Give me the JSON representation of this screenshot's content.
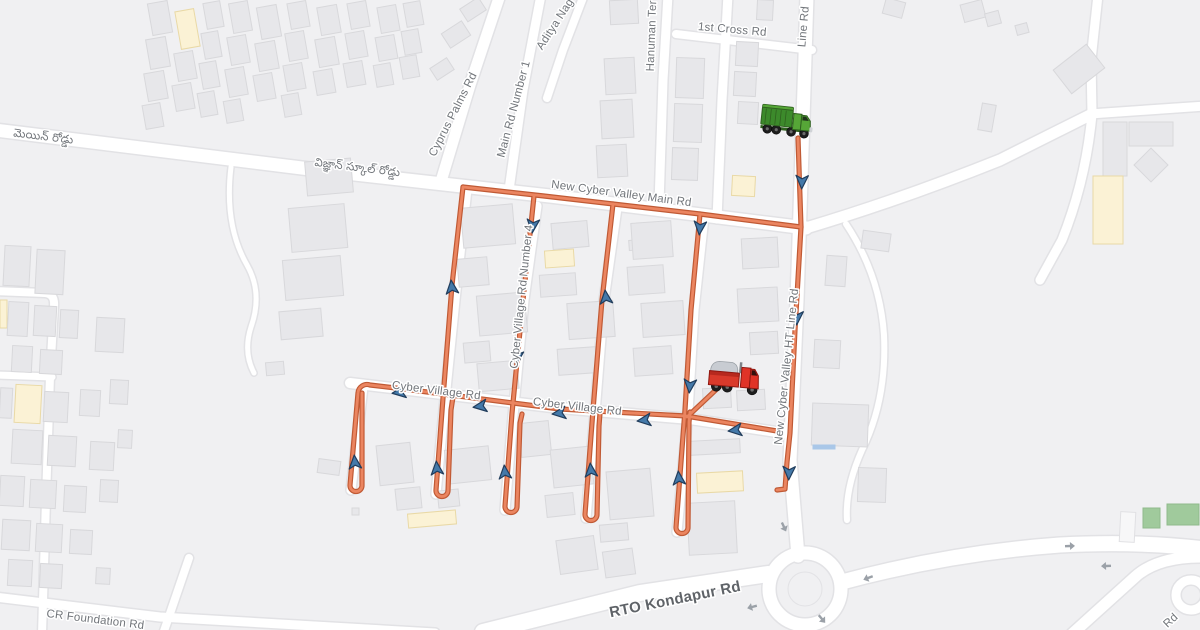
{
  "map": {
    "width": 1200,
    "height": 630,
    "colors": {
      "bg": "#f0f0f2",
      "road_fill": "#ffffff",
      "road_casing": "#e2e2e5",
      "building": "#e7e7ea",
      "building_stroke": "#d8d8db",
      "building_yellow": "#fbf2d5",
      "building_yellow_stroke": "#e9d9a6",
      "building_green": "#a0ca9c",
      "building_green_stroke": "#8fba8c",
      "building_white": "#f7f7f8",
      "building_white_stroke": "#e0e0e3",
      "building_blue": "#a9c7e8",
      "route_casing": "#c05a35",
      "route": "#eb8560",
      "route_arrow_fill": "#4479a9",
      "route_arrow_stroke": "#213d5c",
      "traffic_arrow": "#9ba1a8",
      "label": "#71757a",
      "label_major": "#5f6368"
    },
    "road_labels": [
      {
        "t": "1st Cross Rd",
        "x": 732,
        "y": 33,
        "r": 5,
        "s": 11.5
      },
      {
        "t": "Line Rd",
        "x": 807,
        "y": 27,
        "r": -85,
        "s": 11.5
      },
      {
        "t": "Hanuman Ter",
        "x": 655,
        "y": 36,
        "r": -88,
        "s": 11.5
      },
      {
        "t": "Aditya Nag",
        "x": 558,
        "y": 26,
        "r": -57,
        "s": 11.5
      },
      {
        "t": "Main Rd Number 1",
        "x": 517,
        "y": 110,
        "r": -75,
        "s": 11.5
      },
      {
        "t": "Cyprus Palms Rd",
        "x": 456,
        "y": 116,
        "r": -63,
        "s": 11.5
      },
      {
        "t": "మెయిన్ రోడ్డు",
        "x": 43,
        "y": 140,
        "r": 7,
        "s": 11.5
      },
      {
        "t": "విజ్ఞాన్ స్కూల్ రోడ్డు",
        "x": 357,
        "y": 171,
        "r": 7,
        "s": 11.5
      },
      {
        "t": "New Cyber Valley Main Rd",
        "x": 621,
        "y": 197,
        "r": 7.5,
        "s": 11.5
      },
      {
        "t": "Cyber Village Rd Number 4",
        "x": 525,
        "y": 297,
        "r": -84,
        "s": 11.5
      },
      {
        "t": "New Cyber Valley HT Line Rd",
        "x": 790,
        "y": 367,
        "r": -84,
        "s": 11.5
      },
      {
        "t": "Cyber Village Rd",
        "x": 436,
        "y": 394,
        "r": 7,
        "s": 11.5
      },
      {
        "t": "Cyber Village Rd",
        "x": 577,
        "y": 410,
        "r": 6.5,
        "s": 11.5
      },
      {
        "t": "RTO Kondapur Rd",
        "x": 676,
        "y": 604,
        "r": -11.5,
        "s": 15,
        "w": 600,
        "c": "#5f6368"
      },
      {
        "t": "CR Foundation Rd",
        "x": 95,
        "y": 623,
        "r": 7,
        "s": 11.5
      },
      {
        "t": "Rd",
        "x": 1173,
        "y": 623,
        "r": -43,
        "s": 11.5
      }
    ],
    "roads": [
      {
        "d": "M-5,130 L310,169 L550,196 L806,228",
        "w": 13
      },
      {
        "d": "M806,228 Q900,200 1000,160 L1092,114",
        "w": 11
      },
      {
        "d": "M1090,114 L1205,106",
        "w": 9
      },
      {
        "d": "M1098,-5 L1091,60 L1092,114 Q1086,180 1062,240 L1040,280",
        "w": 9
      },
      {
        "d": "M500,-5 L470,85 L442,178",
        "w": 11
      },
      {
        "d": "M541,-5 L523,90 L509,190",
        "w": 9
      },
      {
        "d": "M584,-5 L563,50 L547,98",
        "w": 8
      },
      {
        "d": "M668,-5 L663,80 L659,205",
        "w": 9
      },
      {
        "d": "M728,-5 L722,100 L717,219",
        "w": 9
      },
      {
        "d": "M676,34 L812,50",
        "w": 8
      },
      {
        "d": "M807,-5 L802,150 L797,300 L790,460 L798,556",
        "w": 13
      },
      {
        "d": "M350,383 L560,408 L690,419 L790,434",
        "w": 10
      },
      {
        "d": "M467,189 L455,300 L445,399 L436,494",
        "w": 9
      },
      {
        "d": "M537,206 L524,300 L513,416 L505,510",
        "w": 9
      },
      {
        "d": "M617,208 L604,300 L595,413 L586,518",
        "w": 9
      },
      {
        "d": "M704,217 L694,310 L688,412 L677,532",
        "w": 9
      },
      {
        "d": "M363,387 L351,490",
        "w": 9
      },
      {
        "d": "M483,632 L640,593 L768,574",
        "w": 16
      },
      {
        "d": "M842,582 Q950,553 1060,545 Q1140,541 1205,549",
        "w": 15
      },
      {
        "d": "M806,625 L808,634",
        "w": 11
      },
      {
        "d": "M1072,634 L1135,577 Q1158,556 1205,557",
        "w": 11
      },
      {
        "circle": [
          1191,
          595,
          15
        ],
        "w": 9
      },
      {
        "circle": [
          805,
          589,
          36
        ],
        "w": 13
      },
      {
        "d": "M-5,291 L45,293 Q55,294 54,306 L50,376 L46,500 L42,634",
        "w": 8
      },
      {
        "d": "M-5,375 L52,377",
        "w": 7
      },
      {
        "d": "M231,167 Q224,225 247,265 Q263,293 251,327 Q243,352 254,373",
        "w": 5
      },
      {
        "d": "M846,224 Q880,275 884,335 Q887,400 862,450 Q845,488 847,520",
        "w": 6
      },
      {
        "d": "M-5,597 L160,617 L435,633",
        "w": 9
      },
      {
        "d": "M189,558 L163,634",
        "w": 8
      }
    ],
    "roundabout_island": [
      805,
      589,
      17
    ],
    "buildings": [
      [
        150,
        2,
        20,
        32,
        -10
      ],
      [
        148,
        38,
        20,
        30,
        -10
      ],
      [
        146,
        72,
        20,
        28,
        -10
      ],
      [
        144,
        104,
        18,
        24,
        -10
      ],
      [
        178,
        10,
        19,
        38,
        -10,
        "y"
      ],
      [
        176,
        52,
        19,
        28,
        -10
      ],
      [
        174,
        84,
        19,
        26,
        -10
      ],
      [
        205,
        2,
        17,
        26,
        -10
      ],
      [
        203,
        32,
        17,
        26,
        -10
      ],
      [
        201,
        62,
        17,
        26,
        -10
      ],
      [
        199,
        92,
        17,
        24,
        -10
      ],
      [
        231,
        2,
        19,
        30,
        -10
      ],
      [
        229,
        36,
        19,
        28,
        -10
      ],
      [
        227,
        68,
        19,
        28,
        -10
      ],
      [
        225,
        100,
        17,
        22,
        -10
      ],
      [
        259,
        6,
        20,
        32,
        -10
      ],
      [
        257,
        42,
        20,
        28,
        -10
      ],
      [
        255,
        74,
        19,
        26,
        -10
      ],
      [
        289,
        2,
        19,
        26,
        -10
      ],
      [
        287,
        32,
        19,
        28,
        -10
      ],
      [
        285,
        64,
        19,
        26,
        -10
      ],
      [
        283,
        94,
        17,
        22,
        -10
      ],
      [
        319,
        6,
        20,
        28,
        -10
      ],
      [
        317,
        38,
        20,
        28,
        -10
      ],
      [
        315,
        70,
        19,
        24,
        -10
      ],
      [
        349,
        2,
        19,
        26,
        -10
      ],
      [
        347,
        32,
        19,
        26,
        -10
      ],
      [
        345,
        62,
        19,
        24,
        -10
      ],
      [
        379,
        6,
        19,
        26,
        -10
      ],
      [
        377,
        36,
        19,
        24,
        -10
      ],
      [
        375,
        64,
        17,
        22,
        -10
      ],
      [
        405,
        2,
        17,
        24,
        -10
      ],
      [
        403,
        30,
        17,
        24,
        -10
      ],
      [
        401,
        56,
        17,
        22,
        -10
      ],
      [
        444,
        26,
        24,
        17,
        -33
      ],
      [
        462,
        2,
        22,
        15,
        -33
      ],
      [
        432,
        62,
        20,
        14,
        -33
      ],
      [
        736,
        42,
        22,
        24,
        3
      ],
      [
        734,
        72,
        22,
        24,
        3
      ],
      [
        738,
        102,
        20,
        22,
        3
      ],
      [
        757,
        0,
        16,
        20,
        3
      ],
      [
        732,
        176,
        23,
        20,
        3,
        "y"
      ],
      [
        676,
        58,
        28,
        40,
        2
      ],
      [
        674,
        104,
        28,
        38,
        2
      ],
      [
        672,
        148,
        26,
        32,
        2
      ],
      [
        610,
        0,
        28,
        24,
        -3
      ],
      [
        605,
        58,
        30,
        36,
        -3
      ],
      [
        601,
        100,
        32,
        38,
        -3
      ],
      [
        597,
        145,
        30,
        32,
        -3
      ],
      [
        884,
        0,
        20,
        16,
        15
      ],
      [
        962,
        2,
        22,
        18,
        -15
      ],
      [
        986,
        12,
        14,
        13,
        -15
      ],
      [
        980,
        104,
        14,
        27,
        10
      ],
      [
        1058,
        54,
        42,
        30,
        -38
      ],
      [
        1016,
        24,
        12,
        10,
        -15
      ],
      [
        1103,
        122,
        24,
        54,
        0
      ],
      [
        1129,
        122,
        44,
        24,
        0
      ],
      [
        1139,
        153,
        24,
        24,
        -45
      ],
      [
        1093,
        176,
        30,
        68,
        0,
        "y"
      ],
      [
        306,
        160,
        46,
        34,
        -5
      ],
      [
        290,
        206,
        56,
        44,
        -5
      ],
      [
        284,
        258,
        58,
        40,
        -5
      ],
      [
        280,
        310,
        42,
        28,
        -5
      ],
      [
        266,
        362,
        18,
        13,
        -5
      ],
      [
        462,
        206,
        52,
        40,
        -5
      ],
      [
        458,
        258,
        30,
        28,
        -5
      ],
      [
        478,
        294,
        48,
        40,
        -5
      ],
      [
        464,
        342,
        26,
        20,
        -5
      ],
      [
        478,
        362,
        40,
        28,
        -5
      ],
      [
        552,
        222,
        36,
        26,
        -5
      ],
      [
        545,
        250,
        29,
        17,
        -4,
        "y"
      ],
      [
        540,
        274,
        36,
        22,
        -4
      ],
      [
        568,
        302,
        46,
        36,
        -4
      ],
      [
        558,
        348,
        38,
        26,
        -4
      ],
      [
        629,
        240,
        14,
        10,
        -4
      ],
      [
        632,
        222,
        40,
        36,
        -4
      ],
      [
        628,
        266,
        36,
        28,
        -4
      ],
      [
        642,
        302,
        42,
        34,
        -4
      ],
      [
        634,
        347,
        38,
        28,
        -4
      ],
      [
        742,
        238,
        36,
        30,
        -3
      ],
      [
        738,
        288,
        40,
        34,
        -3
      ],
      [
        750,
        332,
        28,
        22,
        -3
      ],
      [
        703,
        388,
        28,
        20,
        -3
      ],
      [
        737,
        390,
        28,
        20,
        -3
      ],
      [
        826,
        256,
        20,
        30,
        4
      ],
      [
        862,
        232,
        28,
        18,
        8
      ],
      [
        814,
        340,
        26,
        28,
        3
      ],
      [
        812,
        404,
        56,
        42,
        2
      ],
      [
        813,
        445,
        22,
        4,
        0,
        "b"
      ],
      [
        858,
        468,
        28,
        34,
        2
      ],
      [
        378,
        444,
        34,
        40,
        -6
      ],
      [
        396,
        488,
        25,
        21,
        -6
      ],
      [
        446,
        448,
        44,
        34,
        -6
      ],
      [
        438,
        490,
        21,
        17,
        -6
      ],
      [
        520,
        422,
        30,
        34,
        -6
      ],
      [
        552,
        448,
        40,
        38,
        -6
      ],
      [
        546,
        494,
        28,
        22,
        -6
      ],
      [
        608,
        470,
        44,
        48,
        -5
      ],
      [
        600,
        524,
        28,
        17,
        -5
      ],
      [
        690,
        440,
        50,
        14,
        -3
      ],
      [
        697,
        472,
        46,
        20,
        -3,
        "y"
      ],
      [
        688,
        502,
        48,
        52,
        -3
      ],
      [
        408,
        512,
        48,
        14,
        -5,
        "y"
      ],
      [
        318,
        460,
        22,
        14,
        8
      ],
      [
        352,
        508,
        7,
        7,
        0
      ],
      [
        558,
        538,
        38,
        34,
        -8
      ],
      [
        604,
        550,
        30,
        26,
        -8
      ],
      [
        4,
        246,
        26,
        40,
        3
      ],
      [
        36,
        250,
        28,
        44,
        3
      ],
      [
        0,
        300,
        7,
        28,
        0,
        "y"
      ],
      [
        8,
        302,
        20,
        34,
        3
      ],
      [
        34,
        306,
        22,
        30,
        3
      ],
      [
        60,
        310,
        18,
        28,
        3
      ],
      [
        96,
        318,
        28,
        34,
        3
      ],
      [
        12,
        346,
        20,
        26,
        3
      ],
      [
        40,
        350,
        22,
        24,
        3
      ],
      [
        110,
        380,
        18,
        24,
        3
      ],
      [
        80,
        390,
        20,
        26,
        3
      ],
      [
        0,
        388,
        12,
        30,
        3
      ],
      [
        15,
        385,
        26,
        38,
        3,
        "y"
      ],
      [
        44,
        392,
        24,
        30,
        3
      ],
      [
        12,
        430,
        30,
        34,
        3
      ],
      [
        48,
        436,
        28,
        30,
        3
      ],
      [
        90,
        442,
        24,
        28,
        3
      ],
      [
        118,
        430,
        14,
        18,
        3
      ],
      [
        0,
        476,
        24,
        30,
        3
      ],
      [
        30,
        480,
        26,
        28,
        3
      ],
      [
        64,
        486,
        22,
        26,
        3
      ],
      [
        100,
        480,
        18,
        22,
        3
      ],
      [
        2,
        520,
        28,
        30,
        3
      ],
      [
        36,
        524,
        26,
        28,
        3
      ],
      [
        70,
        530,
        22,
        24,
        3
      ],
      [
        8,
        560,
        24,
        26,
        3
      ],
      [
        40,
        564,
        22,
        24,
        3
      ],
      [
        96,
        568,
        14,
        16,
        3
      ],
      [
        1143,
        508,
        17,
        20,
        0,
        "g"
      ],
      [
        1167,
        504,
        32,
        21,
        0,
        "g"
      ],
      [
        1120,
        512,
        15,
        30,
        3,
        "w"
      ]
    ],
    "route": {
      "paths": [
        "M798,138 L801,227 L795,330 L790,433 L787,462 L785,489 L777,490",
        "M801,227 L700,214 L544,196 L463,187",
        "M463,187 L452,285 L443,398 L436,490 a6,6 0 0 0 12,1 L451,410 L453,397",
        "M534,196 L523,300 L512,413 L505,506 a6,6 0 0 0 12,1 L520,423 L522,414",
        "M613,204 L602,300 L593,410 L585,514 a6,6 0 0 0 12,1 L599,426 L600,413",
        "M700,214 L691,310 L685,410 L676,527 a6,6 0 0 0 12,1 L689,422 L690,412",
        "M404,389 L560,409 L686,416 L777,431",
        "M404,389 L370,385 a9,9 0 0 0 -12,8 L350,485 a6,6 0 0 0 12,1 L362,393",
        "M687,417 L720,386"
      ],
      "direction_arrows": [
        [
          802,
          180,
          182
        ],
        [
          797,
          316,
          182
        ],
        [
          700,
          226,
          185
        ],
        [
          533,
          224,
          185
        ],
        [
          517,
          356,
          185
        ],
        [
          690,
          384,
          185
        ],
        [
          789,
          471,
          182
        ],
        [
          452,
          289,
          -6
        ],
        [
          606,
          299,
          -6
        ],
        [
          355,
          464,
          -5
        ],
        [
          437,
          470,
          -5
        ],
        [
          505,
          474,
          -5
        ],
        [
          591,
          472,
          -5
        ],
        [
          679,
          480,
          -5
        ],
        [
          401,
          392,
          -98
        ],
        [
          482,
          406,
          -98
        ],
        [
          561,
          413,
          -97
        ],
        [
          646,
          420,
          -97
        ],
        [
          737,
          430,
          -97
        ]
      ]
    },
    "traffic_arrows": [
      [
        784,
        527,
        155
      ],
      [
        868,
        578,
        -110
      ],
      [
        752,
        607,
        -105
      ],
      [
        822,
        619,
        140
      ],
      [
        1070,
        546,
        88
      ],
      [
        1106,
        566,
        -92
      ]
    ],
    "trucks": {
      "green": {
        "x": 789,
        "y": 123,
        "rot": 6,
        "body": "#56a637",
        "dark": "#2f611f",
        "box": "#3c8a2b"
      },
      "red": {
        "x": 737,
        "y": 379,
        "rot": 5,
        "body": "#d93a2b",
        "dark": "#8e1710",
        "cab": "#e03327",
        "canopy": "#c8ccd2"
      }
    }
  }
}
